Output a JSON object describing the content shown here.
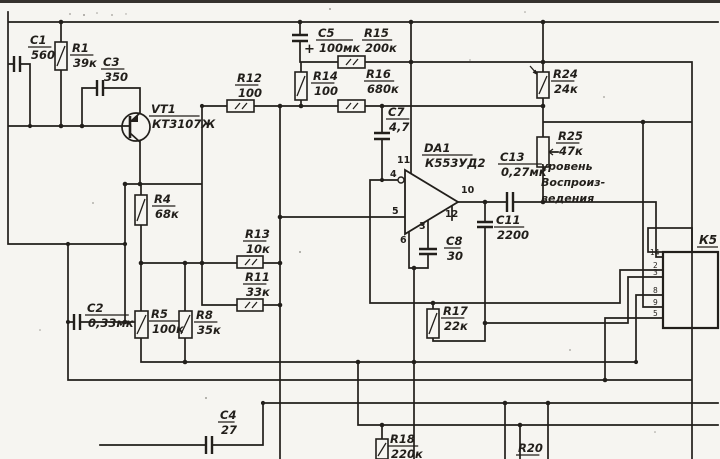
{
  "schematic": {
    "colors": {
      "ink": "#221f1b",
      "paper": "#f6f5f1"
    },
    "labels": [
      {
        "id": "C1",
        "ref": "C1",
        "val": "560",
        "x": 30,
        "y": 34
      },
      {
        "id": "R1",
        "ref": "R1",
        "val": "39к",
        "x": 72,
        "y": 42
      },
      {
        "id": "C3",
        "ref": "C3",
        "val": "350",
        "x": 103,
        "y": 56
      },
      {
        "id": "VT1",
        "ref": "VT1",
        "val": "КТ3107Ж",
        "x": 151,
        "y": 103
      },
      {
        "id": "R12",
        "ref": "R12",
        "val": "100",
        "x": 237,
        "y": 72
      },
      {
        "id": "C5",
        "ref": "C5",
        "val": "100мк",
        "x": 318,
        "y": 27
      },
      {
        "id": "R15",
        "ref": "R15",
        "val": "200к",
        "x": 364,
        "y": 27
      },
      {
        "id": "R14",
        "ref": "R14",
        "val": "100",
        "x": 313,
        "y": 70
      },
      {
        "id": "R16",
        "ref": "R16",
        "val": "680к",
        "x": 366,
        "y": 68
      },
      {
        "id": "C7",
        "ref": "C7",
        "val": "4,7",
        "x": 388,
        "y": 106
      },
      {
        "id": "DA1",
        "ref": "DA1",
        "val": "К553УД2",
        "x": 424,
        "y": 142
      },
      {
        "id": "C13",
        "ref": "C13",
        "val": "0,27мк",
        "x": 500,
        "y": 151
      },
      {
        "id": "R24",
        "ref": "R24",
        "val": "24к",
        "x": 553,
        "y": 68
      },
      {
        "id": "R25",
        "ref": "R25",
        "val": "47к",
        "x": 558,
        "y": 130
      },
      {
        "id": "C11",
        "ref": "C11",
        "val": "2200",
        "x": 496,
        "y": 214
      },
      {
        "id": "C8",
        "ref": "C8",
        "val": "30",
        "x": 446,
        "y": 235
      },
      {
        "id": "R17",
        "ref": "R17",
        "val": "22к",
        "x": 443,
        "y": 305
      },
      {
        "id": "R4",
        "ref": "R4",
        "val": "68к",
        "x": 154,
        "y": 193
      },
      {
        "id": "R13",
        "ref": "R13",
        "val": "10к",
        "x": 245,
        "y": 228
      },
      {
        "id": "R11",
        "ref": "R11",
        "val": "33к",
        "x": 245,
        "y": 271
      },
      {
        "id": "C2",
        "ref": "C2",
        "val": "0,33мк",
        "x": 87,
        "y": 302
      },
      {
        "id": "R5",
        "ref": "R5",
        "val": "100к",
        "x": 151,
        "y": 308
      },
      {
        "id": "R8",
        "ref": "R8",
        "val": "35к",
        "x": 196,
        "y": 309
      },
      {
        "id": "C4",
        "ref": "C4",
        "val": "27",
        "x": 220,
        "y": 409
      },
      {
        "id": "R18",
        "ref": "R18",
        "val": "220к",
        "x": 390,
        "y": 433
      },
      {
        "id": "R20",
        "ref": "R20",
        "val": "",
        "x": 518,
        "y": 442
      }
    ],
    "plus_sign": "+",
    "opamp": {
      "ref": "DA1",
      "part": "К553УД2"
    },
    "opamp_pins": [
      {
        "t": "11",
        "x": 397,
        "y": 163
      },
      {
        "t": "4",
        "x": 390,
        "y": 177
      },
      {
        "t": "5",
        "x": 392,
        "y": 214
      },
      {
        "t": "6",
        "x": 400,
        "y": 243
      },
      {
        "t": "3",
        "x": 419,
        "y": 229
      },
      {
        "t": "10",
        "x": 461,
        "y": 193
      },
      {
        "t": "12",
        "x": 445,
        "y": 217
      }
    ],
    "connector": {
      "label": "К5",
      "pins": [
        {
          "t": "14",
          "x": 650,
          "y": 255
        },
        {
          "t": "2",
          "x": 653,
          "y": 268
        },
        {
          "t": "3",
          "x": 653,
          "y": 275
        },
        {
          "t": "8",
          "x": 653,
          "y": 293
        },
        {
          "t": "9",
          "x": 653,
          "y": 305
        },
        {
          "t": "5",
          "x": 653,
          "y": 316
        }
      ]
    },
    "annotation": [
      "уровень",
      "Воспроиз-",
      "ведения"
    ]
  }
}
